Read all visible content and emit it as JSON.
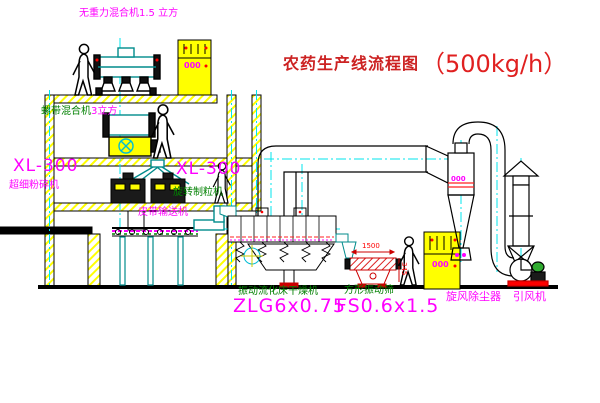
{
  "title": {
    "cn": "农药生产线流程图",
    "capacity": "（500kg/h）"
  },
  "labels": {
    "mixer_top": "无重力混合机1.5 立方",
    "ribbon_mixer": "螺带混合机",
    "ribbon_mixer_size": "3立方",
    "xl300_left": "XL-300",
    "mill_left": "超细粉碎机",
    "xl300_mid": "XL-300",
    "granulator": "旋转制粒机",
    "belt_conveyor": "皮带输送机",
    "dryer_name": "振动流化床干燥机",
    "dryer_model": "ZLG6x0.75",
    "sieve_name": "方形振动筛",
    "sieve_model": "FS0.6x1.5",
    "cyclone": "旋风除尘器",
    "fan": "引风机",
    "dim_width": "1500",
    "dim_height": "345",
    "panel_top_tag": "000",
    "panel_right_tag": "000",
    "cyclone_tag": "000"
  },
  "colors": {
    "label_magenta": "#ff00ff",
    "label_green": "#008000",
    "title_red": "#cc2222",
    "dim_red": "#ff0000",
    "machine_teal": "#008b8b",
    "centerline_cyan": "#00e5ee",
    "hatch_yellow": "#ffff00",
    "cabinet_yellow": "#ffff00",
    "line_black": "#000000"
  }
}
